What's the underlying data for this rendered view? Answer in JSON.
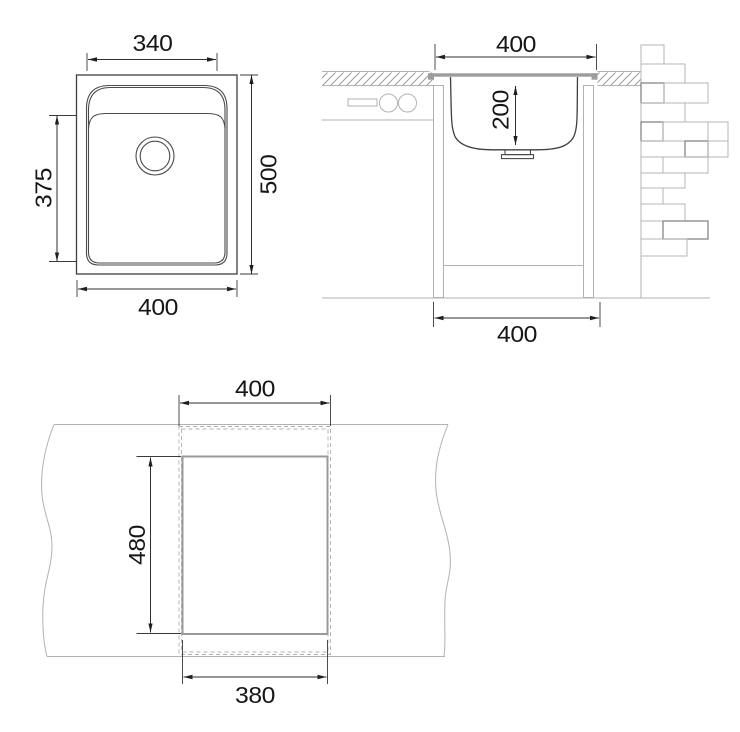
{
  "dimensions": {
    "plan_top": "340",
    "plan_left": "375",
    "plan_right": "500",
    "plan_bottom": "400",
    "section_top": "400",
    "section_depth": "200",
    "section_bottom": "400",
    "cutout_top": "400",
    "cutout_side": "480",
    "cutout_bottom": "380"
  },
  "colors": {
    "line_dark": "#3f3f3f",
    "line_light": "#b2b2b2",
    "steel_gray": "#9c9c9c",
    "text": "#161616",
    "background": "#ffffff"
  }
}
